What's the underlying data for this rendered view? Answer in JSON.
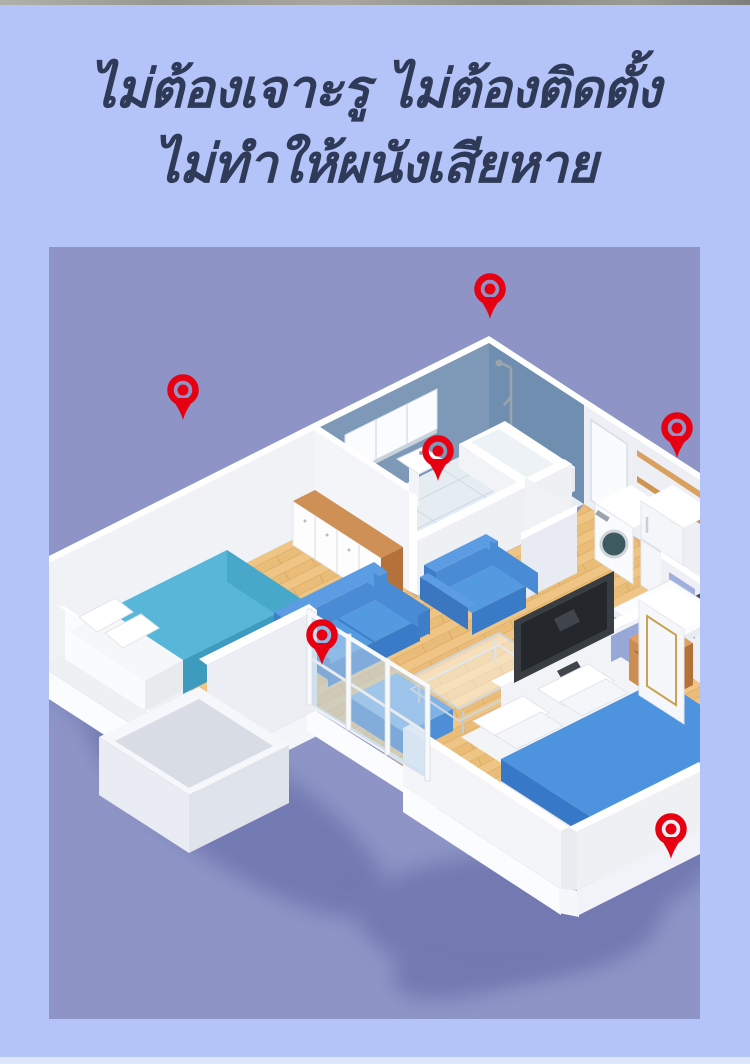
{
  "page": {
    "background": "#b4c3f8",
    "top_strip_color": "#9a9a96",
    "bottom_strip_color": "#dde6fb"
  },
  "title": {
    "line1": "ไม่ต้องเจาะรู ไม่ต้องติดตั้ง",
    "line2": "ไม่ทำให้ผนังเสียหาย",
    "color": "#2e3a57"
  },
  "floorplan": {
    "description_colors": {
      "background": "#8e95c6",
      "pin_red": "#e60011",
      "wood_floor": "#eec584",
      "bathroom_wall_blue": "#7e99b8",
      "sofa_blue": "#4a8bd5",
      "bed_blanket_cyan": "#58b6d8",
      "bed2_blanket_blue": "#4e93de"
    },
    "pins": [
      {
        "name": "bathroom-top-corner",
        "x": 441,
        "y": 42
      },
      {
        "name": "bedroom-back-wall",
        "x": 134,
        "y": 143
      },
      {
        "name": "bathroom-partition",
        "x": 389,
        "y": 204
      },
      {
        "name": "kitchen-shelf",
        "x": 628,
        "y": 181
      },
      {
        "name": "living-room-sofa",
        "x": 273,
        "y": 388
      },
      {
        "name": "bedroom2-outer-wall",
        "x": 622,
        "y": 582
      }
    ]
  }
}
